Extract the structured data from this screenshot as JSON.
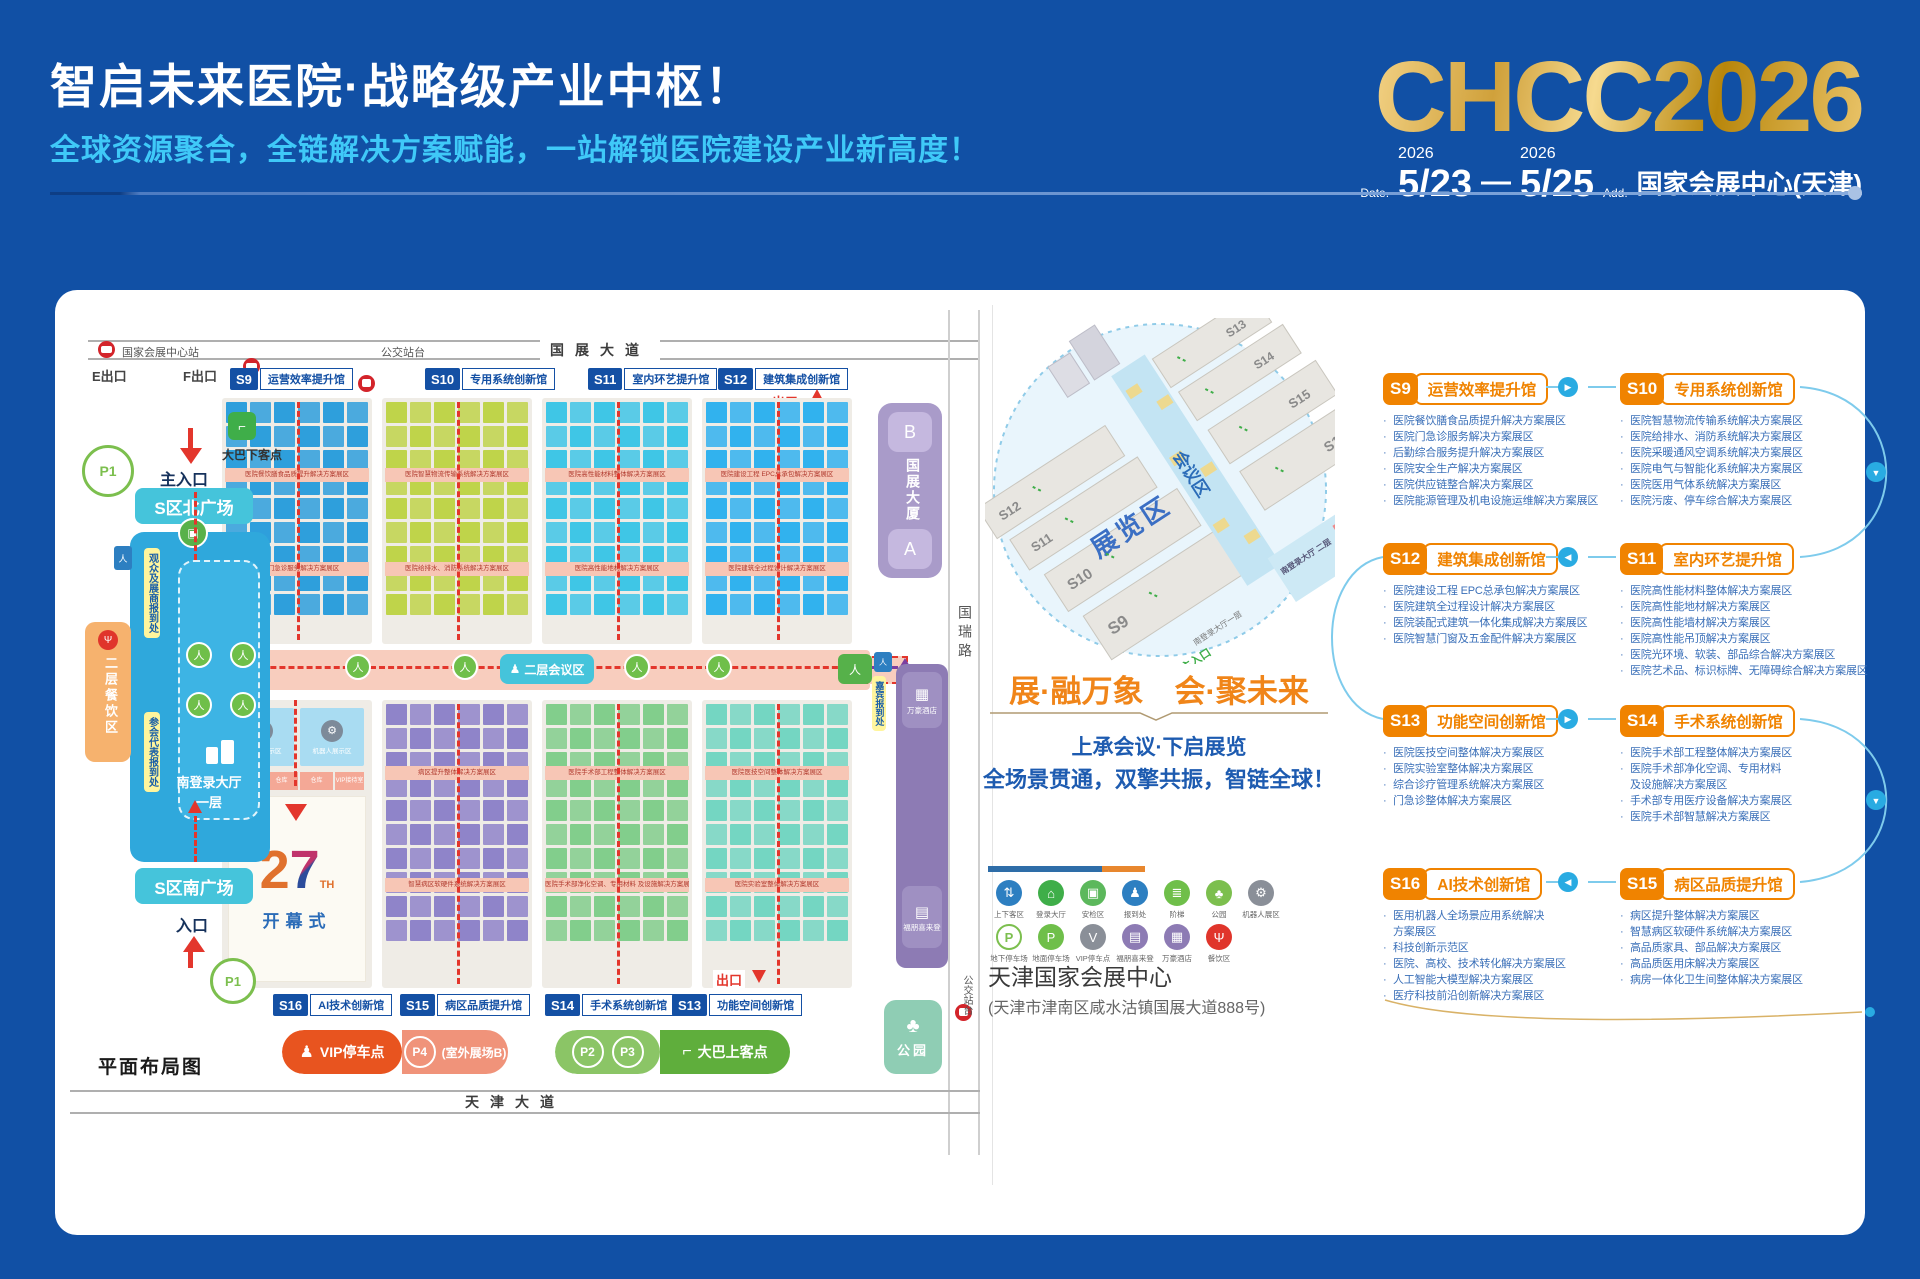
{
  "header": {
    "title": "智启未来医院·战略级产业中枢！",
    "subtitle": "全球资源聚合，全链解决方案赋能，一站解锁医院建设产业新高度！",
    "logo": "CHCC2026",
    "date_label": "Date.",
    "year1": "2026",
    "day1": "5/23",
    "dash": "—",
    "year2": "2026",
    "day2": "5/25",
    "addr_label": "Add.",
    "venue": "国家会展中心(天津)"
  },
  "map": {
    "caption": "平面布局图",
    "top_road": {
      "station": "国家会展中心站",
      "bus": "公交站台",
      "road": "国展大道",
      "exit_e": "E出口",
      "exit_f": "F出口"
    },
    "exit_top": "出口",
    "exit_bottom": "出口",
    "bottom_road": "天津大道",
    "side_road": "国瑞路",
    "side_bus": "公交站台",
    "halls_top": [
      {
        "id": "S9",
        "name": "运营效率提升馆",
        "color": "#2E9FDC",
        "sec": 0
      },
      {
        "id": "S10",
        "name": "专用系统创新馆",
        "color": "#BFD44A",
        "sec": 1
      },
      {
        "id": "S11",
        "name": "室内环艺提升馆",
        "color": "#3FC6E6",
        "sec": 3
      },
      {
        "id": "S12",
        "name": "建筑集成创新馆",
        "color": "#31B2EE",
        "sec": 2
      }
    ],
    "halls_bottom": [
      {
        "id": "S16",
        "name": "AI技术创新馆",
        "color": "#A9DCF2",
        "sec": 6
      },
      {
        "id": "S15",
        "name": "病区品质提升馆",
        "color": "#8F84C9",
        "sec": 7
      },
      {
        "id": "S14",
        "name": "手术系统创新馆",
        "color": "#82CE8C",
        "sec": 5
      },
      {
        "id": "S13",
        "name": "功能空间创新馆",
        "color": "#74D6C2",
        "sec": 4
      }
    ],
    "left": {
      "p1": "P1",
      "main_entrance": "主入口",
      "bus_drop": "大巴下客点",
      "north_plaza": "S区北广场",
      "reg_visitor": "观众及展商报到处",
      "reg_delegate": "参会代表报到处",
      "lobby_name": "南登录大厅",
      "lobby_floor": "一层",
      "dining": "二层餐饮区",
      "south_plaza": "S区南广场",
      "entrance": "入口",
      "wc": "∙∙"
    },
    "center": {
      "conference": "二层会议区",
      "opening_num": "2",
      "opening_seven": "7",
      "opening_th": "TH",
      "opening": "开幕式",
      "robot": "机器人展示区",
      "vip_room": "VIP接待室",
      "storage": "仓库"
    },
    "right": {
      "tower": "国展大厦",
      "tower_b": "B",
      "tower_a": "A",
      "guest_reg": "嘉宾报到处",
      "hotel_marriott": "万豪酒店",
      "hotel_fourpoints": "福朋喜来登",
      "park": "公园"
    },
    "legend_pills": {
      "vip_parking": "VIP停车点",
      "p4": "P4",
      "p4_note": "(室外展场B)",
      "p2": "P2",
      "p3": "P3",
      "bus_boarding": "大巴上客点"
    }
  },
  "panel": {
    "iso": {
      "zone_expo": "展览区",
      "zone_conf": "会议区",
      "s9": "S9",
      "s10": "S10",
      "s11": "S11",
      "s12": "S12",
      "s13": "S13",
      "s14": "S14",
      "s15": "S15",
      "s16": "S16",
      "lobby2": "南登录大厅 二层",
      "lobby1": "南登录大厅一层",
      "entrance": "主入口",
      "dining": "餐饮区"
    },
    "slogan": "展·融万象　会·聚未来",
    "line1": "上承会议·下启展览",
    "line2": "全场景贯通，双擎共振，智链全球！",
    "legend": {
      "row1": [
        {
          "label": "上下客区",
          "icon": "pickup-dropoff-icon",
          "glyph": "⇅",
          "color": "#2D7FC1"
        },
        {
          "label": "登录大厅",
          "icon": "login-hall-icon",
          "glyph": "⌂",
          "color": "#3FAE49"
        },
        {
          "label": "安检区",
          "icon": "security-check-icon",
          "glyph": "▣",
          "color": "#5CB85C"
        },
        {
          "label": "报到处",
          "icon": "registration-icon",
          "glyph": "♟",
          "color": "#2D7FC1"
        },
        {
          "label": "阶梯",
          "icon": "stairs-icon",
          "glyph": "≣",
          "color": "#6FBF4A"
        },
        {
          "label": "公园",
          "icon": "park-icon",
          "glyph": "♣",
          "color": "#7CBF4E"
        },
        {
          "label": "机器人展区",
          "icon": "robot-zone-icon",
          "glyph": "⚙",
          "color": "#8A8F98"
        }
      ],
      "row2": [
        {
          "label": "地下停车场",
          "icon": "underground-parking-icon",
          "glyph": "P",
          "color": "#7CBF4E",
          "ring": true
        },
        {
          "label": "地面停车场",
          "icon": "ground-parking-icon",
          "glyph": "P",
          "color": "#6FBF4A"
        },
        {
          "label": "VIP停车点",
          "icon": "vip-parking-icon",
          "glyph": "V",
          "color": "#8A8F98"
        },
        {
          "label": "福朋喜来登",
          "icon": "four-points-hotel-icon",
          "glyph": "▤",
          "color": "#8D7BB4"
        },
        {
          "label": "万豪酒店",
          "icon": "marriott-hotel-icon",
          "glyph": "▦",
          "color": "#8D7BB4"
        },
        {
          "label": "餐饮区",
          "icon": "dining-icon",
          "glyph": "Ψ",
          "color": "#E0352B"
        }
      ]
    },
    "venue_name": "天津国家会展中心",
    "venue_address": "(天津市津南区咸水沽镇国展大道888号)"
  },
  "sections": [
    {
      "id": "S9",
      "name": "运营效率提升馆",
      "items": [
        "医院餐饮膳食品质提升解决方案展区",
        "医院门急诊服务解决方案展区",
        "后勤综合服务提升解决方案展区",
        "医院安全生产解决方案展区",
        "医院供应链整合解决方案展区",
        "医院能源管理及机电设施运维解决方案展区"
      ]
    },
    {
      "id": "S10",
      "name": "专用系统创新馆",
      "items": [
        "医院智慧物流传输系统解决方案展区",
        "医院给排水、消防系统解决方案展区",
        "医院采暖通风空调系统解决方案展区",
        "医院电气与智能化系统解决方案展区",
        "医院医用气体系统解决方案展区",
        "医院污废、停车综合解决方案展区"
      ]
    },
    {
      "id": "S12",
      "name": "建筑集成创新馆",
      "items": [
        "医院建设工程 EPC总承包解决方案展区",
        "医院建筑全过程设计解决方案展区",
        "医院装配式建筑一体化集成解决方案展区",
        "医院智慧门窗及五金配件解决方案展区"
      ]
    },
    {
      "id": "S11",
      "name": "室内环艺提升馆",
      "items": [
        "医院高性能材料整体解决方案展区",
        "医院高性能地材解决方案展区",
        "医院高性能墙材解决方案展区",
        "医院高性能吊顶解决方案展区",
        "医院光环境、软装、部品综合解决方案展区",
        "医院艺术品、标识标牌、无障碍综合解决方案展区"
      ]
    },
    {
      "id": "S13",
      "name": "功能空间创新馆",
      "items": [
        "医院医技空间整体解决方案展区",
        "医院实验室整体解决方案展区",
        "综合诊疗管理系统解决方案展区",
        "门急诊整体解决方案展区"
      ]
    },
    {
      "id": "S14",
      "name": "手术系统创新馆",
      "items": [
        "医院手术部工程整体解决方案展区",
        "医院手术部净化空调、专用材料\n及设施解决方案展区",
        "手术部专用医疗设备解决方案展区",
        "医院手术部智慧解决方案展区"
      ]
    },
    {
      "id": "S16",
      "name": "AI技术创新馆",
      "items": [
        "医用机器人全场景应用系统解决\n方案展区",
        "科技创新示范区",
        "医院、高校、技术转化解决方案展区",
        "人工智能大模型解决方案展区",
        "医疗科技前沿创新解决方案展区"
      ]
    },
    {
      "id": "S15",
      "name": "病区品质提升馆",
      "items": [
        "病区提升整体解决方案展区",
        "智慧病区软硬件系统解决方案展区",
        "高品质家具、部品解决方案展区",
        "高品质医用床解决方案展区",
        "病房一体化卫生间整体解决方案展区"
      ]
    }
  ],
  "flow_arrows": [
    "▶",
    "◀",
    "▶",
    "◀"
  ]
}
